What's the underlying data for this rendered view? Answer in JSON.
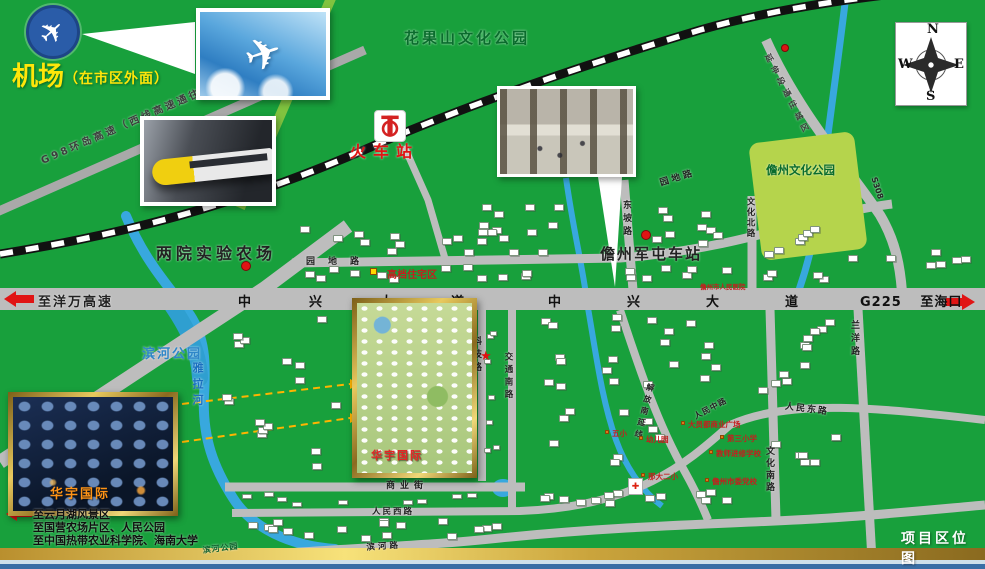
{
  "title": {
    "map_title": "项目区位图"
  },
  "airport": {
    "label": "机场",
    "note": "（在市区外面）"
  },
  "station": {
    "label": "火车站"
  },
  "compass": {
    "n": "N",
    "s": "S",
    "e": "E",
    "w": "W"
  },
  "parks": {
    "huaguoshan": "花果山文化公园",
    "danzhou_culture": "儋州文化公园",
    "binhe": "滨河公园",
    "binhe_small": "滨河公园"
  },
  "river": {
    "yala": "雅拉河"
  },
  "highways": {
    "g98": "G98环岛高速（西线高速通往市区方向）",
    "to_yangwan": "至洋万高速",
    "g225": "G225",
    "to_haikou": "至海口",
    "to_city": "延伸段通往城区",
    "s308": "S308"
  },
  "avenue": {
    "zhongxing": "中兴大道"
  },
  "roads": {
    "yuandi": "园地路",
    "dongpo": "东坡路",
    "wenhua_north": "文化北路",
    "keji": "科技路",
    "jiaotong_south": "交通南路",
    "wenhua_south": "文化南路",
    "lanyang": "兰洋路",
    "renmin_west": "人民西路",
    "renmin_middle": "人民中路",
    "renmin_east": "人民东路",
    "shangye": "商业街",
    "binhe_road": "滨河路",
    "jiefang": "解放南延线"
  },
  "pois": {
    "farm": "两院实验农场",
    "juntun_station": "儋州军屯车站",
    "residence": "高档住宅区",
    "hospital": "儋州市人民医院",
    "hospital_cross": "✚",
    "wuxiao": "五小",
    "kindergarten": "幼儿园",
    "dayuandu": "大员都商业广场",
    "third_primary": "第三小学",
    "jinxiu_school": "教师进修学校",
    "nada_second": "那大二小",
    "party_school": "儋州市委党校"
  },
  "project": {
    "name": "华宇国际"
  },
  "legend": {
    "lines": {
      "l1": "至云月湖风景区",
      "l2": "至国营农场片区、人民公园",
      "l3": "至中国热带农业科学院、海南大学"
    }
  },
  "icons": {
    "plane": "✈",
    "star": "★"
  }
}
